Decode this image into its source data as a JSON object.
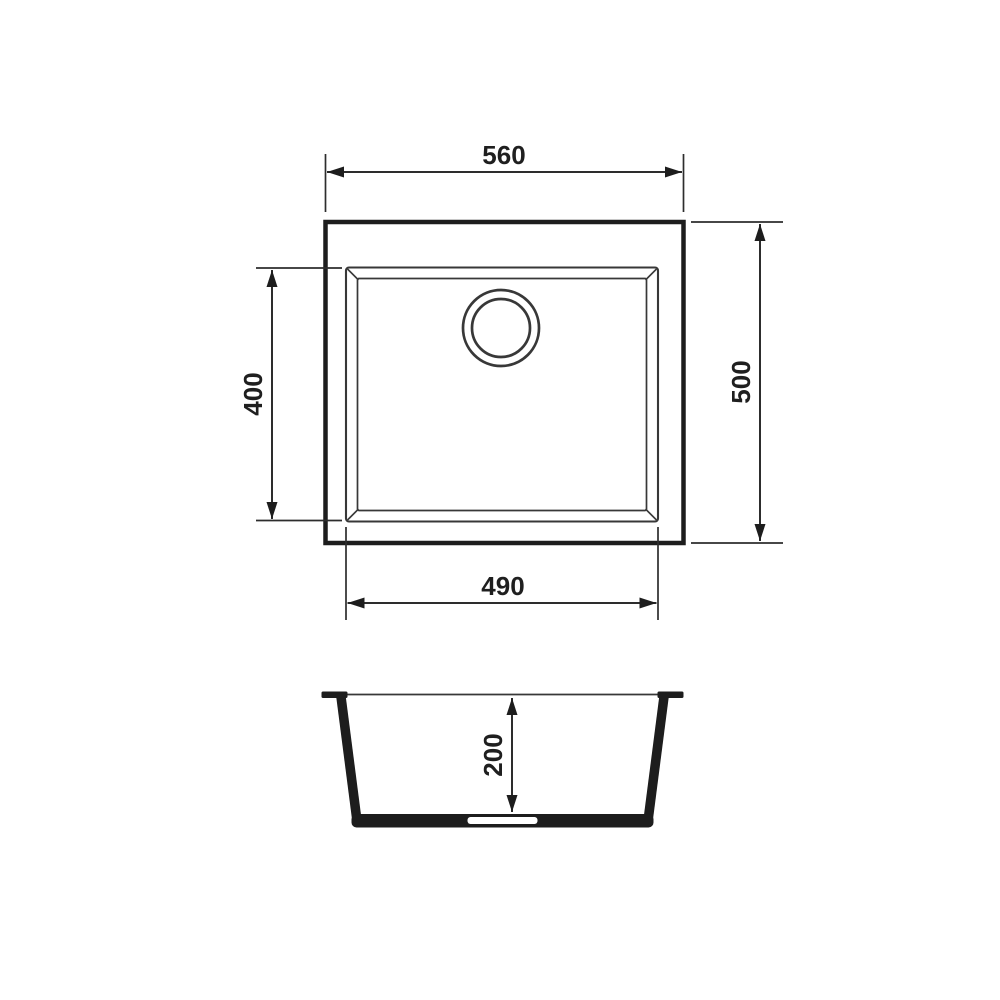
{
  "drawing": {
    "kind": "sink-dimension-drawing",
    "background_color": "#ffffff",
    "line_color": "#1d1d1d",
    "views": {
      "plan": {
        "dims": {
          "overall_width": "560",
          "overall_depth": "500",
          "bowl_width": "490",
          "bowl_depth": "400"
        }
      },
      "section": {
        "dims": {
          "bowl_height": "200"
        }
      }
    }
  }
}
